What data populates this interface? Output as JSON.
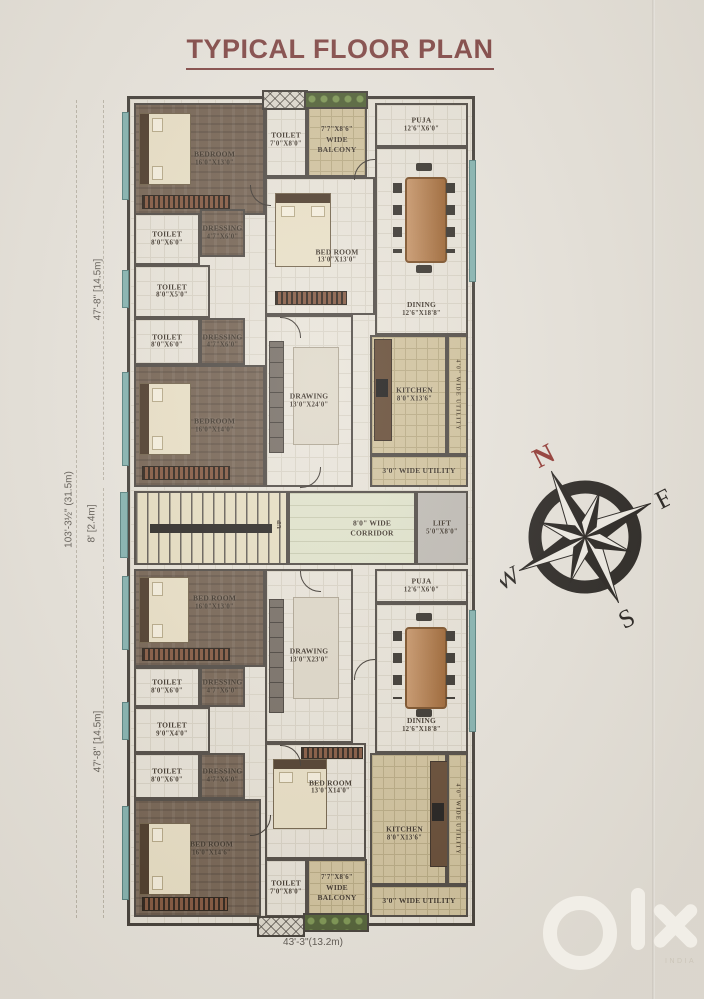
{
  "page": {
    "title": "TYPICAL FLOOR PLAN",
    "watermark_sub": "INDIA"
  },
  "dimensions": {
    "overall_height": "103'-3½\" (31.5m)",
    "upper_wing_height": "47'-8\" [14.5m]",
    "corridor_height": "8' [2.4m]",
    "lower_wing_height": "47'-8\" [14.5m]",
    "overall_width": "43'-3\"(13.2m)"
  },
  "compass": {
    "north": "N",
    "east": "E",
    "south": "S",
    "west": "W"
  },
  "core": {
    "stairs_up": "UP",
    "corridor": {
      "name": "8'0\" WIDE CORRIDOR"
    },
    "lift": {
      "name": "LIFT",
      "size": "5'0\"X8'0\""
    }
  },
  "rooms": {
    "u_bedroom1": {
      "name": "BEDROOM",
      "size": "16'0\"X13'0\""
    },
    "u_toilet_top": {
      "name": "TOILET",
      "size": "7'0\"X8'0\""
    },
    "u_balcony": {
      "size": "7'7\"X8'6\"",
      "name": "WIDE BALCONY"
    },
    "u_puja": {
      "name": "PUJA",
      "size": "12'6\"X6'0\""
    },
    "u_bedroom_c": {
      "name": "BED ROOM",
      "size": "13'0\"X13'0\""
    },
    "u_dining": {
      "name": "DINING",
      "size": "12'6\"X18'8\""
    },
    "u_toilet1": {
      "name": "TOILET",
      "size": "8'0\"X6'0\""
    },
    "u_dressing1": {
      "name": "DRESSING",
      "size": "4'7\"X6'0\""
    },
    "u_toilet2": {
      "name": "TOILET",
      "size": "8'0\"X5'0\""
    },
    "u_toilet3": {
      "name": "TOILET",
      "size": "8'0\"X6'0\""
    },
    "u_dressing2": {
      "name": "DRESSING",
      "size": "4'7\"X6'0\""
    },
    "u_bedroom2": {
      "name": "BEDROOM",
      "size": "16'0\"X14'0\""
    },
    "u_drawing": {
      "name": "DRAWING",
      "size": "13'0\"X24'0\""
    },
    "u_kitchen": {
      "name": "KITCHEN",
      "size": "8'0\"X13'6\""
    },
    "u_utility": {
      "label": "3'0\" WIDE UTILITY"
    },
    "u_utility_side": {
      "label": "4'0\" WIDE UTILITY"
    },
    "l_bedroom1": {
      "name": "BED ROOM",
      "size": "16'0\"X13'0\""
    },
    "l_drawing": {
      "name": "DRAWING",
      "size": "13'0\"X23'0\""
    },
    "l_puja": {
      "name": "PUJA",
      "size": "12'6\"X6'0\""
    },
    "l_dining": {
      "name": "DINING",
      "size": "12'6\"X18'8\""
    },
    "l_toilet1": {
      "name": "TOILET",
      "size": "8'0\"X6'0\""
    },
    "l_dressing1": {
      "name": "DRESSING",
      "size": "4'7\"X6'0\""
    },
    "l_toilet2": {
      "name": "TOILET",
      "size": "9'0\"X4'0\""
    },
    "l_toilet3": {
      "name": "TOILET",
      "size": "8'0\"X6'0\""
    },
    "l_dressing2": {
      "name": "DRESSING",
      "size": "4'7\"X6'0\""
    },
    "l_bedroom2": {
      "name": "BED ROOM",
      "size": "16'0\"X14'6\""
    },
    "l_bedroom3": {
      "name": "BED ROOM",
      "size": "13'0\"X14'0\""
    },
    "l_toilet_bot": {
      "name": "TOILET",
      "size": "7'0\"X8'0\""
    },
    "l_balcony": {
      "size": "7'7\"X8'6\"",
      "name": "WIDE BALCONY"
    },
    "l_kitchen": {
      "name": "KITCHEN",
      "size": "8'0\"X13'6\""
    },
    "l_utility": {
      "label": "3'0\" WIDE UTILITY"
    },
    "l_utility_side": {
      "label": "4'0\" WIDE UTILITY"
    }
  }
}
